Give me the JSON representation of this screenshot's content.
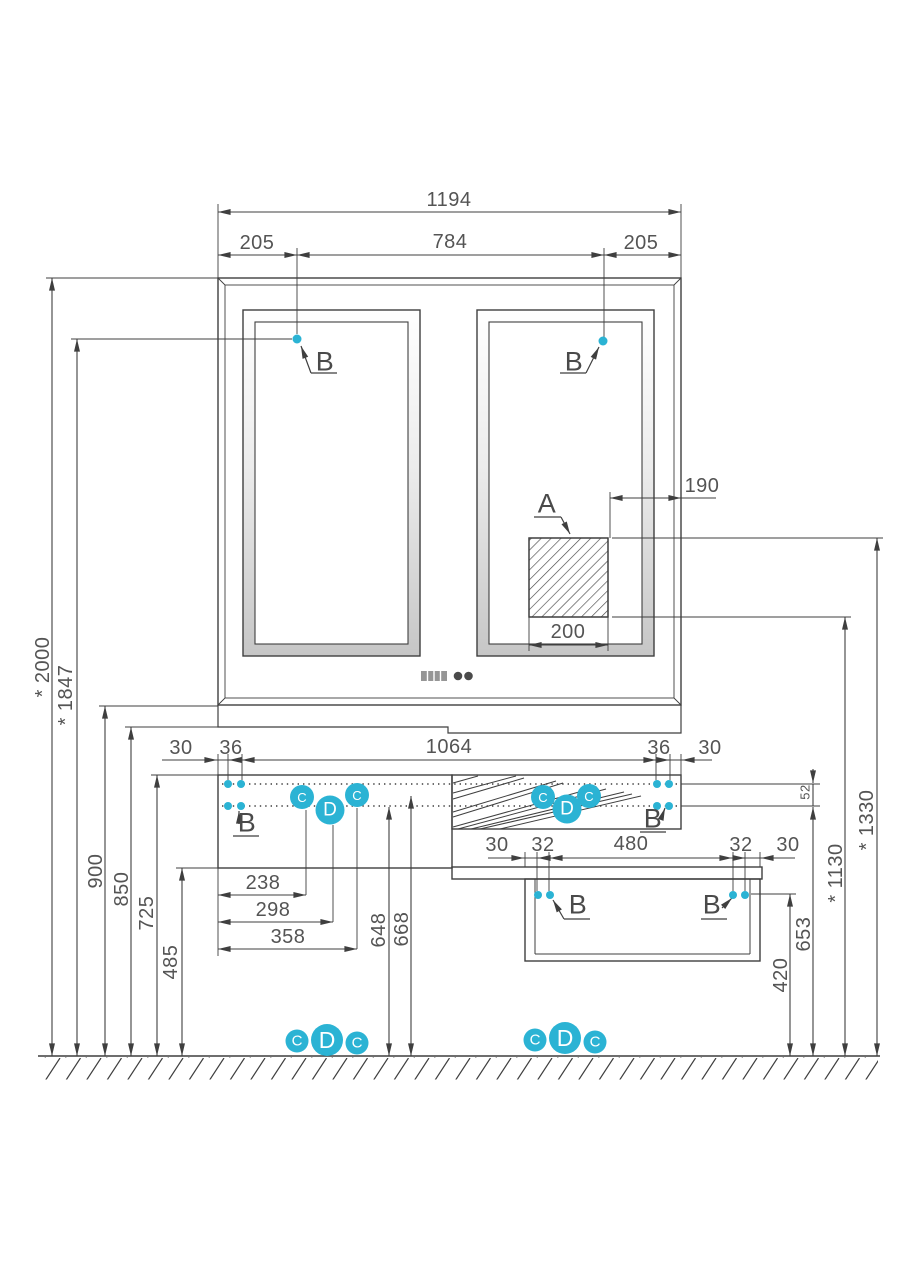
{
  "colors": {
    "accent": "#2bb3d4",
    "line": "#3f3f3f"
  },
  "dims": {
    "total_width": "1194",
    "mirror_offset_left": "205",
    "mirror_spacing": "784",
    "mirror_offset_right": "205",
    "outlet_offset": "190",
    "outlet_width": "200",
    "cabinet_row": [
      "30",
      "36",
      "1064",
      "36",
      "30"
    ],
    "lower_row": [
      "30",
      "32",
      "480",
      "32",
      "30"
    ],
    "drawer_widths": [
      "238",
      "298",
      "358"
    ],
    "left_heights": [
      "* 2000",
      "* 1847",
      "900",
      "850",
      "725",
      "485"
    ],
    "mid_heights": [
      "648",
      "668"
    ],
    "gap": "52",
    "h653": "653",
    "h420": "420",
    "h1130": "* 1130",
    "h1330": "* 1330"
  },
  "markers": {
    "a": "A",
    "b": "B",
    "c": "C",
    "d": "D"
  }
}
